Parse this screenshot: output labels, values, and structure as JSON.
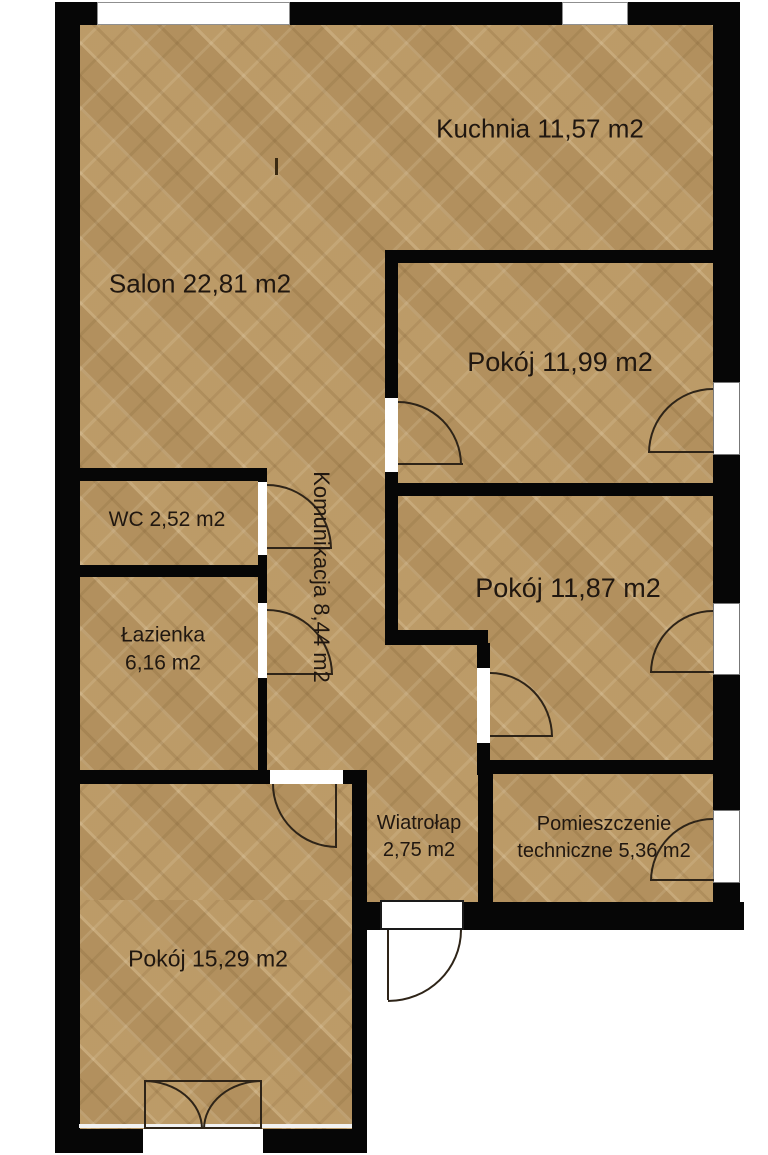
{
  "plan": {
    "type": "apartment-floor-plan",
    "area_unit": "m2",
    "rooms": [
      {
        "id": "kuchnia",
        "label": "Kuchnia 11,57 m2"
      },
      {
        "id": "salon",
        "label": "Salon 22,81 m2"
      },
      {
        "id": "pokoj-1199",
        "label": "Pokój 11,99 m2"
      },
      {
        "id": "wc",
        "label": "WC 2,52 m2"
      },
      {
        "id": "komunikacja",
        "label": "Komunikacja 8,44 m2"
      },
      {
        "id": "lazienka",
        "line1": "Łazienka",
        "line2": "6,16 m2"
      },
      {
        "id": "pokoj-1187",
        "label": "Pokój 11,87 m2"
      },
      {
        "id": "wiatrolap",
        "line1": "Wiatrołap",
        "line2": "2,75 m2"
      },
      {
        "id": "pom-tech",
        "line1": "Pomieszczenie",
        "line2": "techniczne 5,36 m2"
      },
      {
        "id": "pokoj-1529",
        "label": "Pokój 15,29 m2"
      }
    ],
    "colors": {
      "floor": "#b79765",
      "wall": "#060606",
      "exterior": "#ffffff",
      "door_line": "#2e2418",
      "label_text": "#201710"
    }
  }
}
